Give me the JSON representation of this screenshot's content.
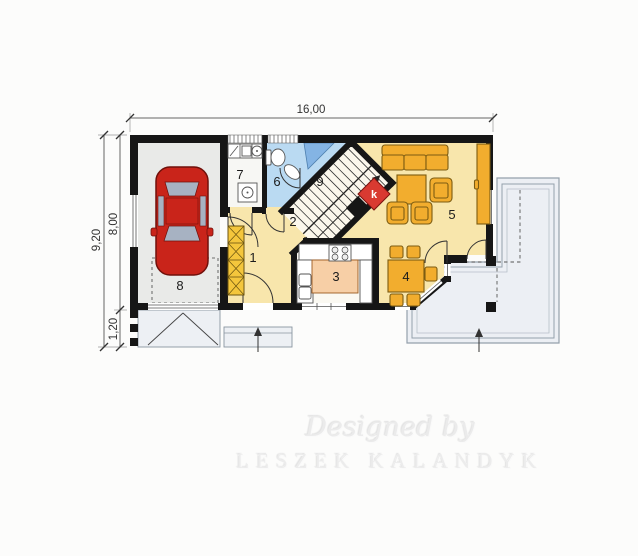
{
  "plan": {
    "dims": {
      "total_width": "16,00",
      "total_height": "9,20",
      "main_height": "8,00",
      "porch_height": "1,20"
    },
    "rooms": {
      "r1": "1",
      "r2": "2",
      "r3": "3",
      "r4": "4",
      "r5": "5",
      "r6": "6",
      "r7": "7",
      "r8": "8",
      "r9": "9"
    },
    "fireplace_label": "k",
    "watermark": {
      "line1": "Designed by",
      "line2": "LESZEK KALANDYK"
    },
    "colors": {
      "wall": "#161616",
      "floor_main": "#f8e6ac",
      "floor_garage": "#e9eae8",
      "floor_bath": "#badaf2",
      "floor_bath_dark": "#84b4e4",
      "floor_kitchen": "#fbf9f2",
      "kitchen_island": "#f7cfa6",
      "furniture": "#f2ad2e",
      "wardrobe": "#f4c63c",
      "fireplace": "#d93a31",
      "car": "#c9241a",
      "car_window": "#a7b2c2",
      "terrace": "#eceff4",
      "dimension_text": "#333333",
      "watermark": "#ebebeb"
    }
  }
}
